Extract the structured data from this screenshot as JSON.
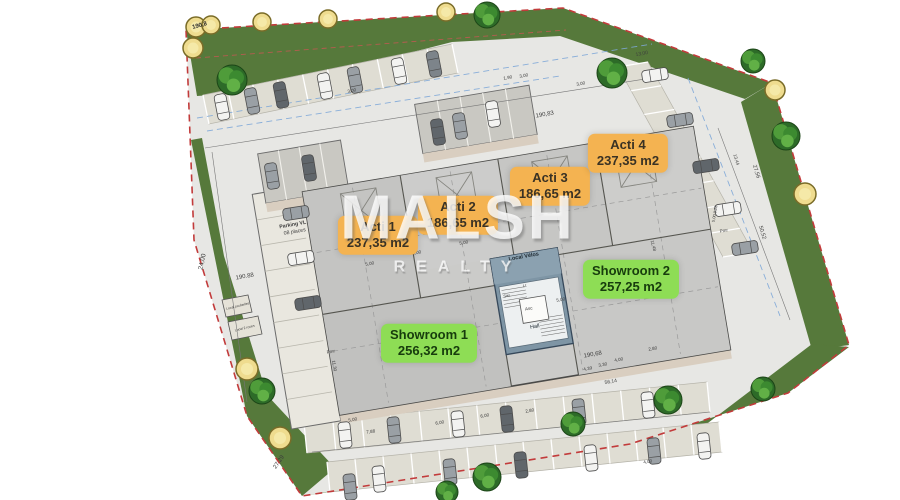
{
  "watermark": {
    "line1": "MALSH",
    "line2": "REALTY"
  },
  "units": [
    {
      "id": "acti-1",
      "name": "Acti 1",
      "area": "237,35 m2",
      "kind": "acti",
      "cx": 378,
      "cy": 235
    },
    {
      "id": "acti-2",
      "name": "Acti 2",
      "area": "186,65 m2",
      "kind": "acti",
      "cx": 458,
      "cy": 215
    },
    {
      "id": "acti-3",
      "name": "Acti 3",
      "area": "186,65 m2",
      "kind": "acti",
      "cx": 550,
      "cy": 186
    },
    {
      "id": "acti-4",
      "name": "Acti 4",
      "area": "237,35 m2",
      "kind": "acti",
      "cx": 628,
      "cy": 153
    },
    {
      "id": "showroom-1",
      "name": "Showroom 1",
      "area": "256,32 m2",
      "kind": "showroom",
      "cx": 429,
      "cy": 343
    },
    {
      "id": "showroom-2",
      "name": "Showroom 2",
      "area": "257,25 m2",
      "kind": "showroom",
      "cx": 631,
      "cy": 279
    }
  ],
  "colors": {
    "acti_label_bg": "#f4b351",
    "acti_label_fg": "#3a3224",
    "showroom_label_bg": "#8edd55",
    "showroom_label_fg": "#173c0d",
    "grass": "#56793b",
    "pavement": "#e7e7e4",
    "boundary": "#c23b3b",
    "building": "#cbcbc9",
    "core": "#7e95a5",
    "stall_backing": "#dfddd3",
    "dim_text": "#3d3d3d",
    "blue_line": "#7fa8d8"
  },
  "annotations": [
    {
      "t": "190,8",
      "x": 200,
      "y": 27,
      "r": -15,
      "s": 6,
      "c": "#2e2e2e",
      "w": 1
    },
    {
      "t": "24,00",
      "x": 204,
      "y": 262,
      "r": -78,
      "s": 6.5
    },
    {
      "t": "190.88",
      "x": 245,
      "y": 278,
      "r": -10,
      "s": 6
    },
    {
      "t": "190,83",
      "x": 545,
      "y": 116,
      "r": -10,
      "s": 6
    },
    {
      "t": "190,68",
      "x": 593,
      "y": 356,
      "r": -10,
      "s": 6
    },
    {
      "t": "56,14",
      "x": 611,
      "y": 383,
      "r": -10,
      "s": 5
    },
    {
      "t": "27,29",
      "x": 280,
      "y": 463,
      "r": -55,
      "s": 6
    },
    {
      "t": "27,56",
      "x": 755,
      "y": 172,
      "r": 73,
      "s": 5.5
    },
    {
      "t": "50,52",
      "x": 761,
      "y": 233,
      "r": 73,
      "s": 5.5
    },
    {
      "t": "13,44",
      "x": 735,
      "y": 160,
      "r": 73,
      "s": 4.5
    },
    {
      "t": "11,48",
      "x": 652,
      "y": 246,
      "r": 75,
      "s": 4.5
    },
    {
      "t": "Parking VL",
      "x": 293,
      "y": 226,
      "r": -10,
      "s": 5.2,
      "w": 1
    },
    {
      "t": "08 places",
      "x": 295,
      "y": 233,
      "r": -10,
      "s": 5.2
    },
    {
      "t": "Local Vélos",
      "x": 524,
      "y": 258,
      "r": -10,
      "s": 5.5,
      "c": "#202b33",
      "w": 1
    },
    {
      "t": "Hall",
      "x": 535,
      "y": 328,
      "r": -10,
      "s": 5.5,
      "c": "#202b33"
    },
    {
      "t": "Asc",
      "x": 529,
      "y": 310,
      "r": -10,
      "s": 4.5
    },
    {
      "t": "Sas",
      "x": 507,
      "y": 297,
      "r": -10,
      "s": 4
    },
    {
      "t": "Lt",
      "x": 525,
      "y": 287,
      "r": -10,
      "s": 4
    },
    {
      "t": "13,00",
      "x": 642,
      "y": 55,
      "r": -10,
      "s": 5
    },
    {
      "t": "1,90",
      "x": 508,
      "y": 79,
      "r": -10,
      "s": 4.5
    },
    {
      "t": "3,00",
      "x": 524,
      "y": 77,
      "r": -10,
      "s": 4.5
    },
    {
      "t": "3,00",
      "x": 581,
      "y": 85,
      "r": -10,
      "s": 4.5
    },
    {
      "t": "3,00",
      "x": 352,
      "y": 92,
      "r": -11,
      "s": 4.5
    },
    {
      "t": "4,39",
      "x": 588,
      "y": 370,
      "r": -10,
      "s": 4.5
    },
    {
      "t": "3,30",
      "x": 603,
      "y": 366,
      "r": -10,
      "s": 4.5
    },
    {
      "t": "4,00",
      "x": 619,
      "y": 361,
      "r": -10,
      "s": 4.5
    },
    {
      "t": "2,80",
      "x": 653,
      "y": 350,
      "r": -10,
      "s": 4.5
    },
    {
      "t": "7,88",
      "x": 371,
      "y": 433,
      "r": -10,
      "s": 4.5
    },
    {
      "t": "5,00",
      "x": 353,
      "y": 421,
      "r": -10,
      "s": 4.5
    },
    {
      "t": "6,00",
      "x": 440,
      "y": 424,
      "r": -10,
      "s": 4.5
    },
    {
      "t": "6,00",
      "x": 485,
      "y": 417,
      "r": -10,
      "s": 4.5
    },
    {
      "t": "2,80",
      "x": 530,
      "y": 412,
      "r": -10,
      "s": 4.5
    },
    {
      "t": "4,00",
      "x": 648,
      "y": 463,
      "r": -10,
      "s": 4.5
    },
    {
      "t": "Pmr",
      "x": 331,
      "y": 353,
      "r": -10,
      "s": 4.5
    },
    {
      "t": "Pmr",
      "x": 724,
      "y": 232,
      "r": -10,
      "s": 4.5
    },
    {
      "t": "5,00 0,28",
      "x": 716,
      "y": 214,
      "r": -80,
      "s": 4
    },
    {
      "t": "Local poubelles",
      "x": 238,
      "y": 307,
      "r": -14,
      "s": 3.4
    },
    {
      "t": "Local 2 roues",
      "x": 245,
      "y": 329,
      "r": -14,
      "s": 3.4
    },
    {
      "t": "5,00",
      "x": 370,
      "y": 265,
      "r": -10,
      "s": 4.5
    },
    {
      "t": "5,00",
      "x": 417,
      "y": 254,
      "r": -10,
      "s": 4.5
    },
    {
      "t": "5,00",
      "x": 464,
      "y": 244,
      "r": -10,
      "s": 4.5
    },
    {
      "t": "5,00",
      "x": 561,
      "y": 301,
      "r": -10,
      "s": 4.5
    },
    {
      "t": "5,00",
      "x": 608,
      "y": 291,
      "r": -10,
      "s": 4.5
    },
    {
      "t": "11,30",
      "x": 333,
      "y": 366,
      "r": 80,
      "s": 4.5
    }
  ],
  "scene": {
    "parking_rows": [
      {
        "x1": 203,
        "y1": 95,
        "x2": 452,
        "y2": 44,
        "dx": 6,
        "dy": 29,
        "n": 10
      },
      {
        "x1": 648,
        "y1": 62,
        "x2": 753,
        "y2": 252,
        "dx": -30,
        "dy": 5,
        "n": 8
      },
      {
        "x1": 307,
        "y1": 453,
        "x2": 710,
        "y2": 412,
        "dx": -3,
        "dy": -30,
        "n": 14
      },
      {
        "x1": 330,
        "y1": 492,
        "x2": 722,
        "y2": 452,
        "dx": -3,
        "dy": -30,
        "n": 14
      }
    ],
    "cars": [
      {
        "x": 222,
        "y": 107,
        "a": 79,
        "c": "#f3f3f1"
      },
      {
        "x": 252,
        "y": 101,
        "a": 79,
        "c": "#9aa0a5"
      },
      {
        "x": 281,
        "y": 95,
        "a": 79,
        "c": "#60666b"
      },
      {
        "x": 325,
        "y": 86,
        "a": 79,
        "c": "#f3f3f1"
      },
      {
        "x": 355,
        "y": 80,
        "a": 79,
        "c": "#9aa0a5"
      },
      {
        "x": 399,
        "y": 71,
        "a": 79,
        "c": "#f3f3f1"
      },
      {
        "x": 434,
        "y": 64,
        "a": 79,
        "c": "#7d848a"
      },
      {
        "x": 272,
        "y": 176,
        "a": 81,
        "c": "#9aa0a5"
      },
      {
        "x": 309,
        "y": 168,
        "a": 81,
        "c": "#60666b"
      },
      {
        "x": 438,
        "y": 132,
        "a": 81,
        "c": "#60666b"
      },
      {
        "x": 460,
        "y": 126,
        "a": 81,
        "c": "#9aa0a5"
      },
      {
        "x": 493,
        "y": 114,
        "a": 81,
        "c": "#f3f3f1"
      },
      {
        "x": 655,
        "y": 75,
        "a": -9,
        "c": "#f3f3f1"
      },
      {
        "x": 680,
        "y": 120,
        "a": -9,
        "c": "#9aa0a5"
      },
      {
        "x": 706,
        "y": 166,
        "a": -9,
        "c": "#60666b"
      },
      {
        "x": 728,
        "y": 209,
        "a": -9,
        "c": "#f3f3f1"
      },
      {
        "x": 745,
        "y": 248,
        "a": -9,
        "c": "#9aa0a5"
      },
      {
        "x": 296,
        "y": 213,
        "a": -9,
        "c": "#9aa0a5"
      },
      {
        "x": 301,
        "y": 258,
        "a": -9,
        "c": "#f3f3f1"
      },
      {
        "x": 308,
        "y": 303,
        "a": -9,
        "c": "#60666b"
      },
      {
        "x": 345,
        "y": 435,
        "a": 84,
        "c": "#f3f3f1"
      },
      {
        "x": 394,
        "y": 430,
        "a": 84,
        "c": "#9aa0a5"
      },
      {
        "x": 458,
        "y": 424,
        "a": 84,
        "c": "#f3f3f1"
      },
      {
        "x": 507,
        "y": 419,
        "a": 84,
        "c": "#60666b"
      },
      {
        "x": 579,
        "y": 412,
        "a": 84,
        "c": "#9aa0a5"
      },
      {
        "x": 648,
        "y": 405,
        "a": 84,
        "c": "#f3f3f1"
      },
      {
        "x": 350,
        "y": 487,
        "a": 84,
        "c": "#9aa0a5"
      },
      {
        "x": 379,
        "y": 479,
        "a": 84,
        "c": "#f3f3f1"
      },
      {
        "x": 450,
        "y": 472,
        "a": 84,
        "c": "#9aa0a5"
      },
      {
        "x": 521,
        "y": 465,
        "a": 84,
        "c": "#60666b"
      },
      {
        "x": 591,
        "y": 458,
        "a": 84,
        "c": "#f3f3f1"
      },
      {
        "x": 654,
        "y": 451,
        "a": 84,
        "c": "#9aa0a5"
      },
      {
        "x": 704,
        "y": 446,
        "a": 84,
        "c": "#f3f3f1"
      }
    ],
    "trees": [
      {
        "x": 232,
        "y": 80,
        "r": 15
      },
      {
        "x": 487,
        "y": 15,
        "r": 13
      },
      {
        "x": 612,
        "y": 73,
        "r": 15
      },
      {
        "x": 753,
        "y": 61,
        "r": 12
      },
      {
        "x": 786,
        "y": 136,
        "r": 14
      },
      {
        "x": 262,
        "y": 391,
        "r": 13
      },
      {
        "x": 487,
        "y": 477,
        "r": 14
      },
      {
        "x": 573,
        "y": 424,
        "r": 12
      },
      {
        "x": 668,
        "y": 400,
        "r": 14
      },
      {
        "x": 763,
        "y": 389,
        "r": 12
      },
      {
        "x": 447,
        "y": 492,
        "r": 11
      }
    ],
    "bushes": [
      {
        "x": 196,
        "y": 27,
        "r": 10
      },
      {
        "x": 211,
        "y": 25,
        "r": 9
      },
      {
        "x": 193,
        "y": 48,
        "r": 10
      },
      {
        "x": 262,
        "y": 22,
        "r": 9
      },
      {
        "x": 328,
        "y": 19,
        "r": 9
      },
      {
        "x": 446,
        "y": 12,
        "r": 9
      },
      {
        "x": 775,
        "y": 90,
        "r": 10
      },
      {
        "x": 805,
        "y": 194,
        "r": 11
      },
      {
        "x": 247,
        "y": 369,
        "r": 11
      },
      {
        "x": 280,
        "y": 438,
        "r": 11
      }
    ]
  }
}
